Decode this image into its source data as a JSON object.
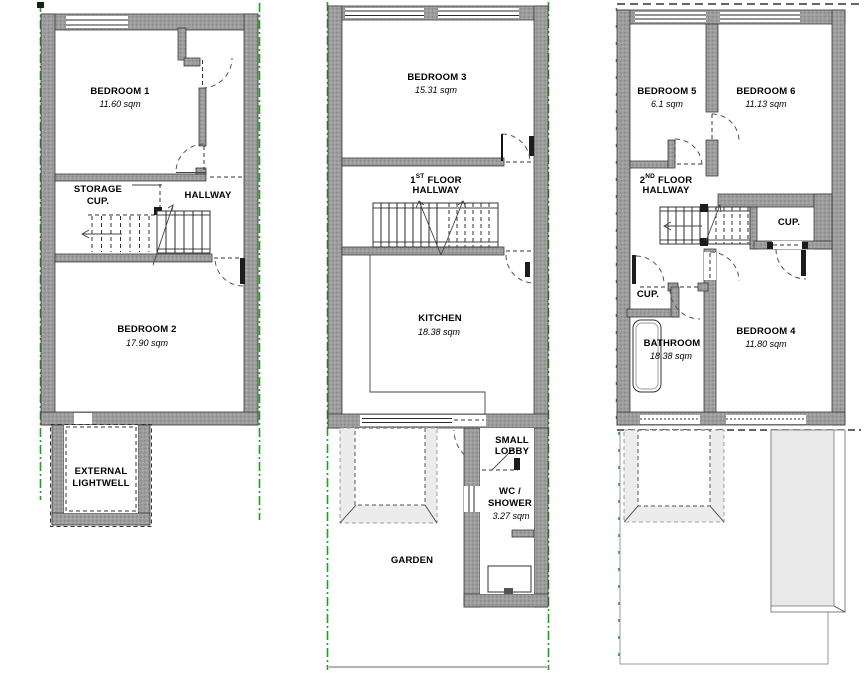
{
  "document": {
    "type": "floor-plan-set",
    "units_note": "sqm"
  },
  "colors": {
    "wall_grey": "#9c9c9c",
    "boundary_green": "#1fa01f",
    "line": "#2b2b2b",
    "ghost_grey": "#e9e9e9"
  },
  "floors": {
    "p1": {
      "name": "lower-ground-floor",
      "bedroom1": "BEDROOM 1",
      "bedroom1_area": "11.60 sqm",
      "storage1": "STORAGE",
      "storage2": "CUP.",
      "hallway": "HALLWAY",
      "bedroom2": "BEDROOM 2",
      "bedroom2_area": "17.90 sqm",
      "lightwell1": "EXTERNAL",
      "lightwell2": "LIGHTWELL"
    },
    "p2": {
      "name": "first-floor",
      "bedroom3": "BEDROOM 3",
      "bedroom3_area": "15.31 sqm",
      "hall_num": "1",
      "hall_ord": "ST",
      "hall_word": "FLOOR",
      "hall_line2": "HALLWAY",
      "kitchen": "KITCHEN",
      "kitchen_area": "18.38 sqm",
      "lobby1": "SMALL",
      "lobby2": "LOBBY",
      "wc1": "WC /",
      "wc2": "SHOWER",
      "wc_area": "3.27 sqm",
      "garden": "GARDEN"
    },
    "p3": {
      "name": "second-floor",
      "bedroom5": "BEDROOM 5",
      "bedroom5_area": "6.1 sqm",
      "bedroom6": "BEDROOM 6",
      "bedroom6_area": "11.13 sqm",
      "hall_num": "2",
      "hall_ord": "ND",
      "hall_word": "FLOOR",
      "hall_line2": "HALLWAY",
      "cup_top": "CUP.",
      "cup_left": "CUP.",
      "bathroom": "BATHROOM",
      "bathroom_area": "18.38 sqm",
      "bedroom4": "BEDROOM 4",
      "bedroom4_area": "11.80 sqm"
    }
  }
}
